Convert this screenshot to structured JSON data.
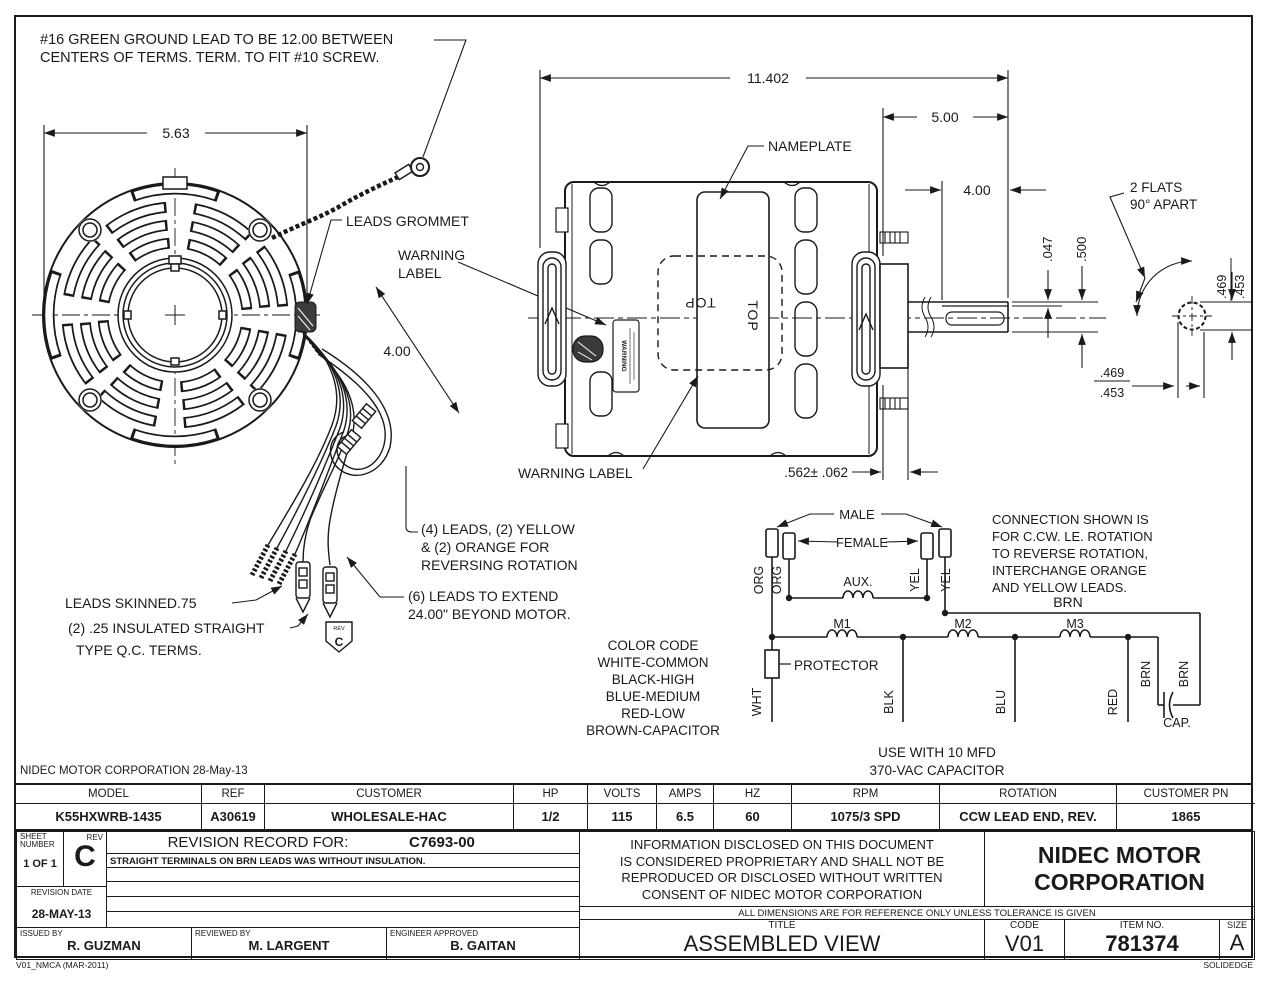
{
  "drawing": {
    "ground_note": [
      "#16 GREEN GROUND LEAD TO BE 12.00 BETWEEN",
      "CENTERS OF TERMS.  TERM. TO FIT #10 SCREW."
    ],
    "dim_5_63": "5.63",
    "leads_grommet": "LEADS GROMMET",
    "warning_label_two_line": [
      "WARNING",
      "LABEL"
    ],
    "dim_4_00_leads": "4.00",
    "leads_skinned": "LEADS SKINNED.75",
    "qc_terms": [
      "(2) .25 INSULATED STRAIGHT",
      "TYPE Q.C. TERMS."
    ],
    "four_leads": [
      "(4) LEADS, (2) YELLOW",
      "& (2) ORANGE FOR",
      "REVERSING ROTATION"
    ],
    "six_leads": [
      "(6) LEADS TO EXTEND",
      "24.00\" BEYOND MOTOR."
    ],
    "rev_tag_small": "REV",
    "rev_tag_letter": "C",
    "dim_11_402": "11.402",
    "nameplate": "NAMEPLATE",
    "dim_5_00": "5.00",
    "dim_4_00_flat": "4.00",
    "dim_047": ".047",
    "dim_500": ".500",
    "top_label": "TOP",
    "warning_label_side": "WARNING LABEL",
    "warning_sticker": "WARNING",
    "dim_562": ".562± .062",
    "flats_note": [
      "2 FLATS",
      "90° APART"
    ],
    "dim_469": ".469",
    "dim_453": ".453"
  },
  "schematic": {
    "male": "MALE",
    "female": "FEMALE",
    "aux": "AUX.",
    "org": "ORG",
    "yel": "YEL",
    "brn": "BRN",
    "m1": "M1",
    "m2": "M2",
    "m3": "M3",
    "protector": "PROTECTOR",
    "wht": "WHT",
    "blk": "BLK",
    "blu": "BLU",
    "red": "RED",
    "cap": "CAP.",
    "connection_note": [
      "CONNECTION SHOWN IS",
      "FOR C.CW. LE. ROTATION",
      "TO REVERSE ROTATION,",
      "INTERCHANGE ORANGE",
      "AND YELLOW LEADS."
    ],
    "color_code": [
      "COLOR CODE",
      "WHITE-COMMON",
      "BLACK-HIGH",
      "BLUE-MEDIUM",
      "RED-LOW",
      "BROWN-CAPACITOR"
    ],
    "capacitor_note": [
      "USE WITH 10 MFD",
      "370-VAC CAPACITOR"
    ]
  },
  "spec_table": {
    "corp_line": "NIDEC MOTOR CORPORATION 28-May-13",
    "headers": [
      "MODEL",
      "REF",
      "CUSTOMER",
      "HP",
      "VOLTS",
      "AMPS",
      "HZ",
      "RPM",
      "ROTATION",
      "CUSTOMER PN"
    ],
    "values": [
      "K55HXWRB-1435",
      "A30619",
      "WHOLESALE-HAC",
      "1/2",
      "115",
      "6.5",
      "60",
      "1075/3 SPD",
      "CCW LEAD END, REV.",
      "1865"
    ]
  },
  "title_block": {
    "sheet_label_1": "SHEET",
    "sheet_label_2": "NUMBER",
    "sheet_value": "1 OF 1",
    "rev_label": "REV",
    "rev_value": "C",
    "revision_record_label": "REVISION RECORD FOR:",
    "revision_record_number": "C7693-00",
    "revision_note": "STRAIGHT TERMINALS ON BRN LEADS WAS WITHOUT INSULATION.",
    "revision_date_label": "REVISION DATE",
    "revision_date": "28-MAY-13",
    "issued_by_label": "ISSUED BY",
    "issued_by": "R. GUZMAN",
    "reviewed_by_label": "REVIEWED BY",
    "reviewed_by": "M. LARGENT",
    "engineer_approved_label": "ENGINEER APPROVED",
    "engineer_approved": "B. GAITAN",
    "proprietary_note": [
      "INFORMATION DISCLOSED ON THIS DOCUMENT",
      "IS CONSIDERED PROPRIETARY AND SHALL NOT BE",
      "REPRODUCED OR DISCLOSED WITHOUT WRITTEN",
      "CONSENT OF NIDEC MOTOR CORPORATION"
    ],
    "company_line1": "NIDEC MOTOR",
    "company_line2": "CORPORATION",
    "tolerance_note": "ALL DIMENSIONS ARE FOR REFERENCE ONLY UNLESS TOLERANCE IS GIVEN",
    "title_label": "TITLE",
    "title": "ASSEMBLED VIEW",
    "code_label": "CODE",
    "code": "V01",
    "item_label": "ITEM NO.",
    "item_no": "781374",
    "size_label": "SIZE",
    "size": "A"
  },
  "footer": {
    "template": "V01_NMCA (MAR-2011)",
    "cad": "SOLIDEDGE"
  }
}
